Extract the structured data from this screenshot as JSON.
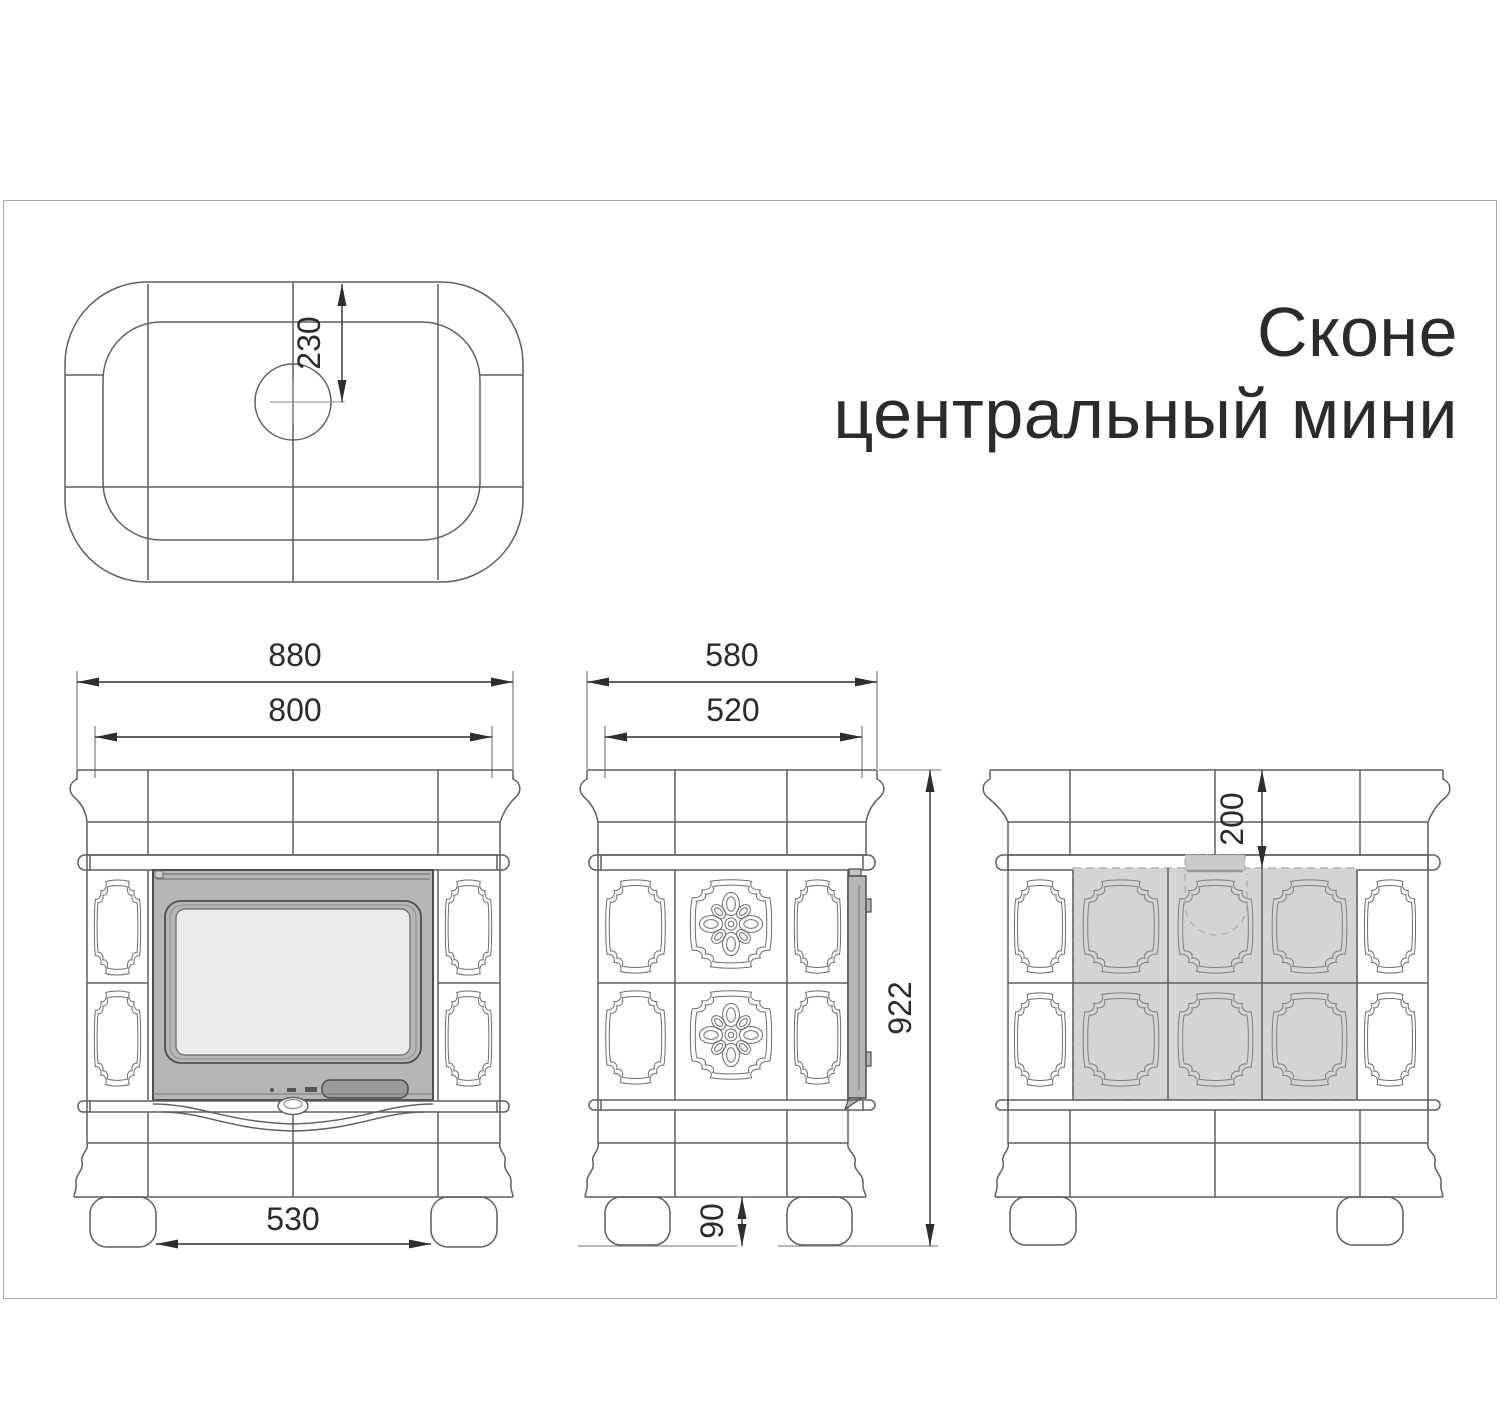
{
  "title": {
    "line1": "Сконе",
    "line2": "центральный мини"
  },
  "dimensions": {
    "top_view": {
      "flue_center_offset": "230"
    },
    "front_view": {
      "overall_width": "880",
      "top_width": "800",
      "feet_inner_width": "530"
    },
    "side_view": {
      "overall_depth": "580",
      "top_depth": "520",
      "overall_height": "922",
      "feet_height": "90"
    },
    "rear_view": {
      "flue_top_offset": "200"
    }
  },
  "colors": {
    "line": "#5f5f5f",
    "dimension": "#2e2e2e",
    "door_frame": "#b5b6b5",
    "glass": "#eaece8",
    "handle": "#9a9a9a",
    "shaded_panel": "#d3d4d3",
    "frame_border": "#a9a9a9"
  }
}
